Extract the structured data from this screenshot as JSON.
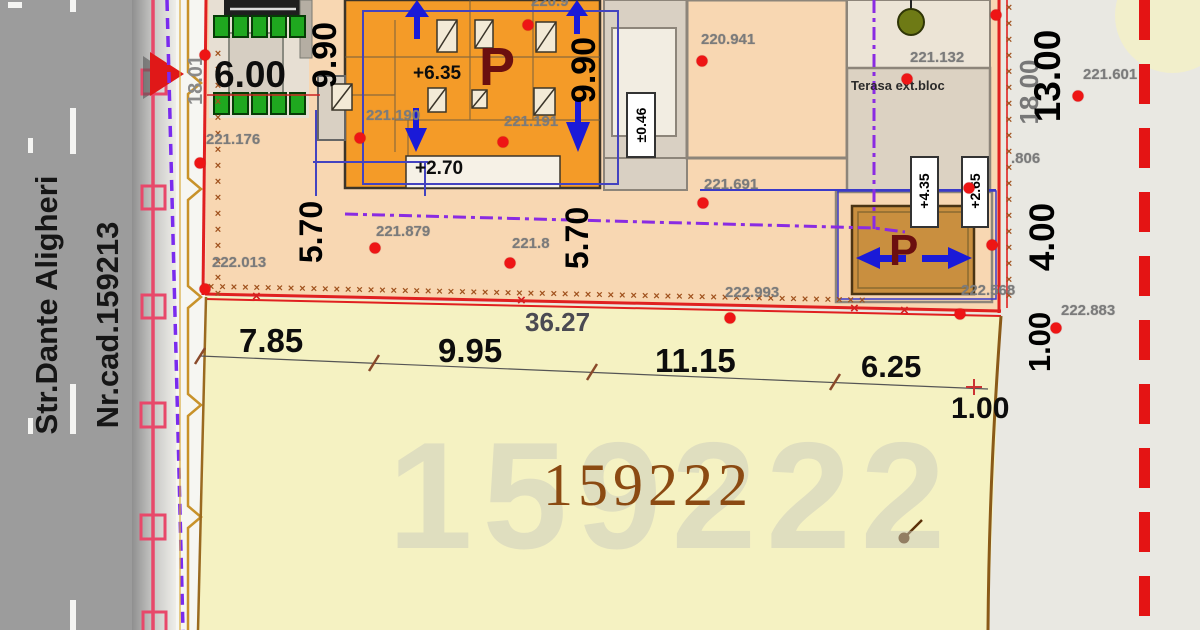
{
  "street": {
    "name": "Str.Dante Aligheri",
    "cad_number": "Nr.cad.159213",
    "road_width": "18.01"
  },
  "parcel": {
    "number": "159222",
    "watermark": "159222"
  },
  "boundary_dims": {
    "front_total": "36.27",
    "seg_7_85": "7.85",
    "seg_9_95": "9.95",
    "seg_11_15": "11.15",
    "seg_6_25": "6.25",
    "offset_bottom": "1.00",
    "offset_right": "1.00",
    "right_13": "13.00",
    "right_18": "18.00",
    "right_4": "4.00"
  },
  "building_dims": {
    "width_6": "6.00",
    "depth_9_90_left": "9.90",
    "depth_9_90_mid": "9.90",
    "setback_5_70_left": "5.70",
    "setback_5_70_mid": "5.70"
  },
  "levels": {
    "roof": "+6.35",
    "mid": "+2.70",
    "ground": "±0.46",
    "small_roof": "+4.35",
    "small_mid": "+2.65"
  },
  "spot_elevations": {
    "e_221_176": "221.176",
    "e_222_013": "222.013",
    "e_221_879": "221.879",
    "e_221_8": "221.8",
    "e_221_190": "221.190",
    "e_221_191": "221.191",
    "e_220_9": "220.9",
    "e_220_941": "220.941",
    "e_221_132": "221.132",
    "e_221_691": "221.691",
    "e_222_993": "222.993",
    "e_222_568": "222.568",
    "e_222_883": "222.883",
    "e_221_601": "221.601",
    "e_806": ".806"
  },
  "labels": {
    "terrace": "Terasa ext.bloc",
    "parking_main": "P",
    "parking_small": "P"
  },
  "colors": {
    "boundary_red": "#e02020",
    "street_line_pink": "#e8486a",
    "fence_tan": "#c8922a",
    "easement_purple": "#7a2bee",
    "building_orange": "#f49b28",
    "parking_brown": "#c98f3f",
    "parcel_yellow": "#f5f2c2",
    "courtyard_peach": "#f8d7b2",
    "road_gray": "#9c9c9c",
    "arrow_blue": "#1a1ad8",
    "p_maroon": "#6b0f0f",
    "survey_dashed_red": "#e41414"
  }
}
